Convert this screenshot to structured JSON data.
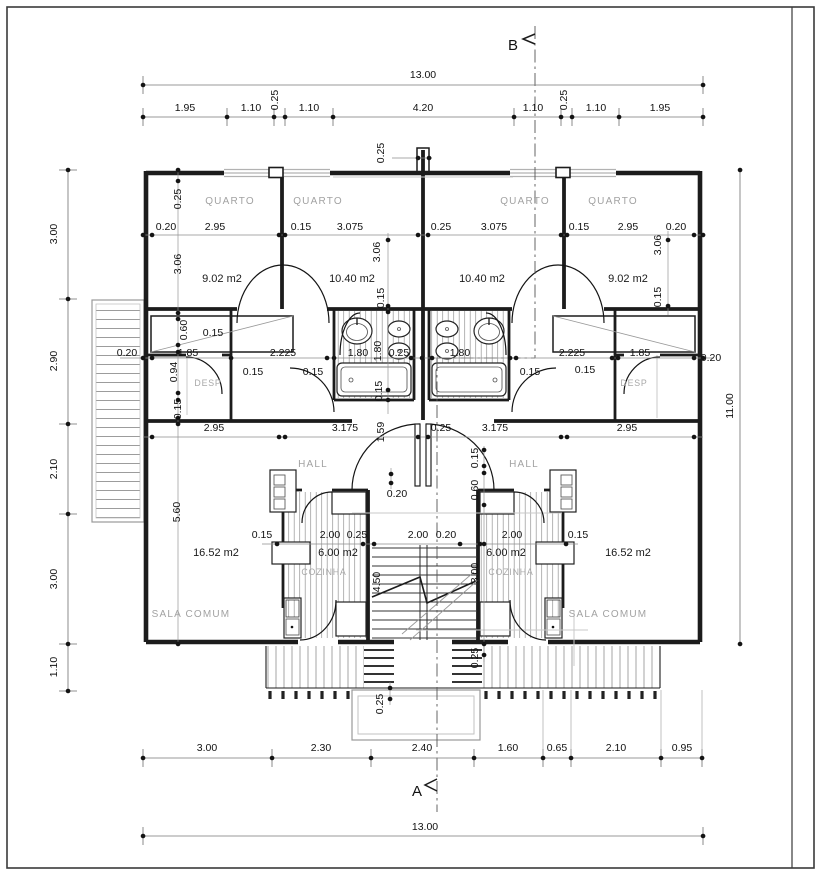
{
  "sections": {
    "a": "A",
    "b": "B"
  },
  "rooms": {
    "quarto": "QUARTO",
    "desp": "DESP",
    "hall": "HALL",
    "cozinha": "COZINHA",
    "sala": "SALA COMUM"
  },
  "areas": {
    "quarto_small": "9.02 m2",
    "quarto_large": "10.40 m2",
    "cozinha": "6.00 m2",
    "sala": "16.52 m2"
  },
  "dimensions": {
    "top": {
      "total": "13.00",
      "segments": [
        "1.95",
        "1.10",
        "0.25",
        "1.10",
        "4.20",
        "1.10",
        "0.25",
        "1.10",
        "1.95"
      ]
    },
    "bottom": {
      "total": "13.00",
      "segments": [
        "3.00",
        "2.30",
        "2.40",
        "1.60",
        "0.65",
        "2.10",
        "0.95"
      ]
    },
    "left": {
      "segments": [
        "3.00",
        "2.90",
        "2.10",
        "3.00",
        "1.10"
      ]
    },
    "right": {
      "total": "11.00"
    },
    "values": {
      "d015": "0.15",
      "d020": "0.20",
      "d025": "0.25",
      "d060": "0.60",
      "d094": "0.94",
      "d159": "1.59",
      "d180": "1.80",
      "d185": "1.85",
      "d200": "2.00",
      "d2225": "2.225",
      "d295": "2.95",
      "d300": "3.00",
      "d306": "3.06",
      "d3075": "3.075",
      "d3175": "3.175",
      "d450": "4.50",
      "d560": "5.60"
    }
  },
  "colors": {
    "wall": "#1c1c1c",
    "dim_line": "#787878",
    "room_text": "#a2a2a2",
    "window": "#b2b2b2"
  }
}
